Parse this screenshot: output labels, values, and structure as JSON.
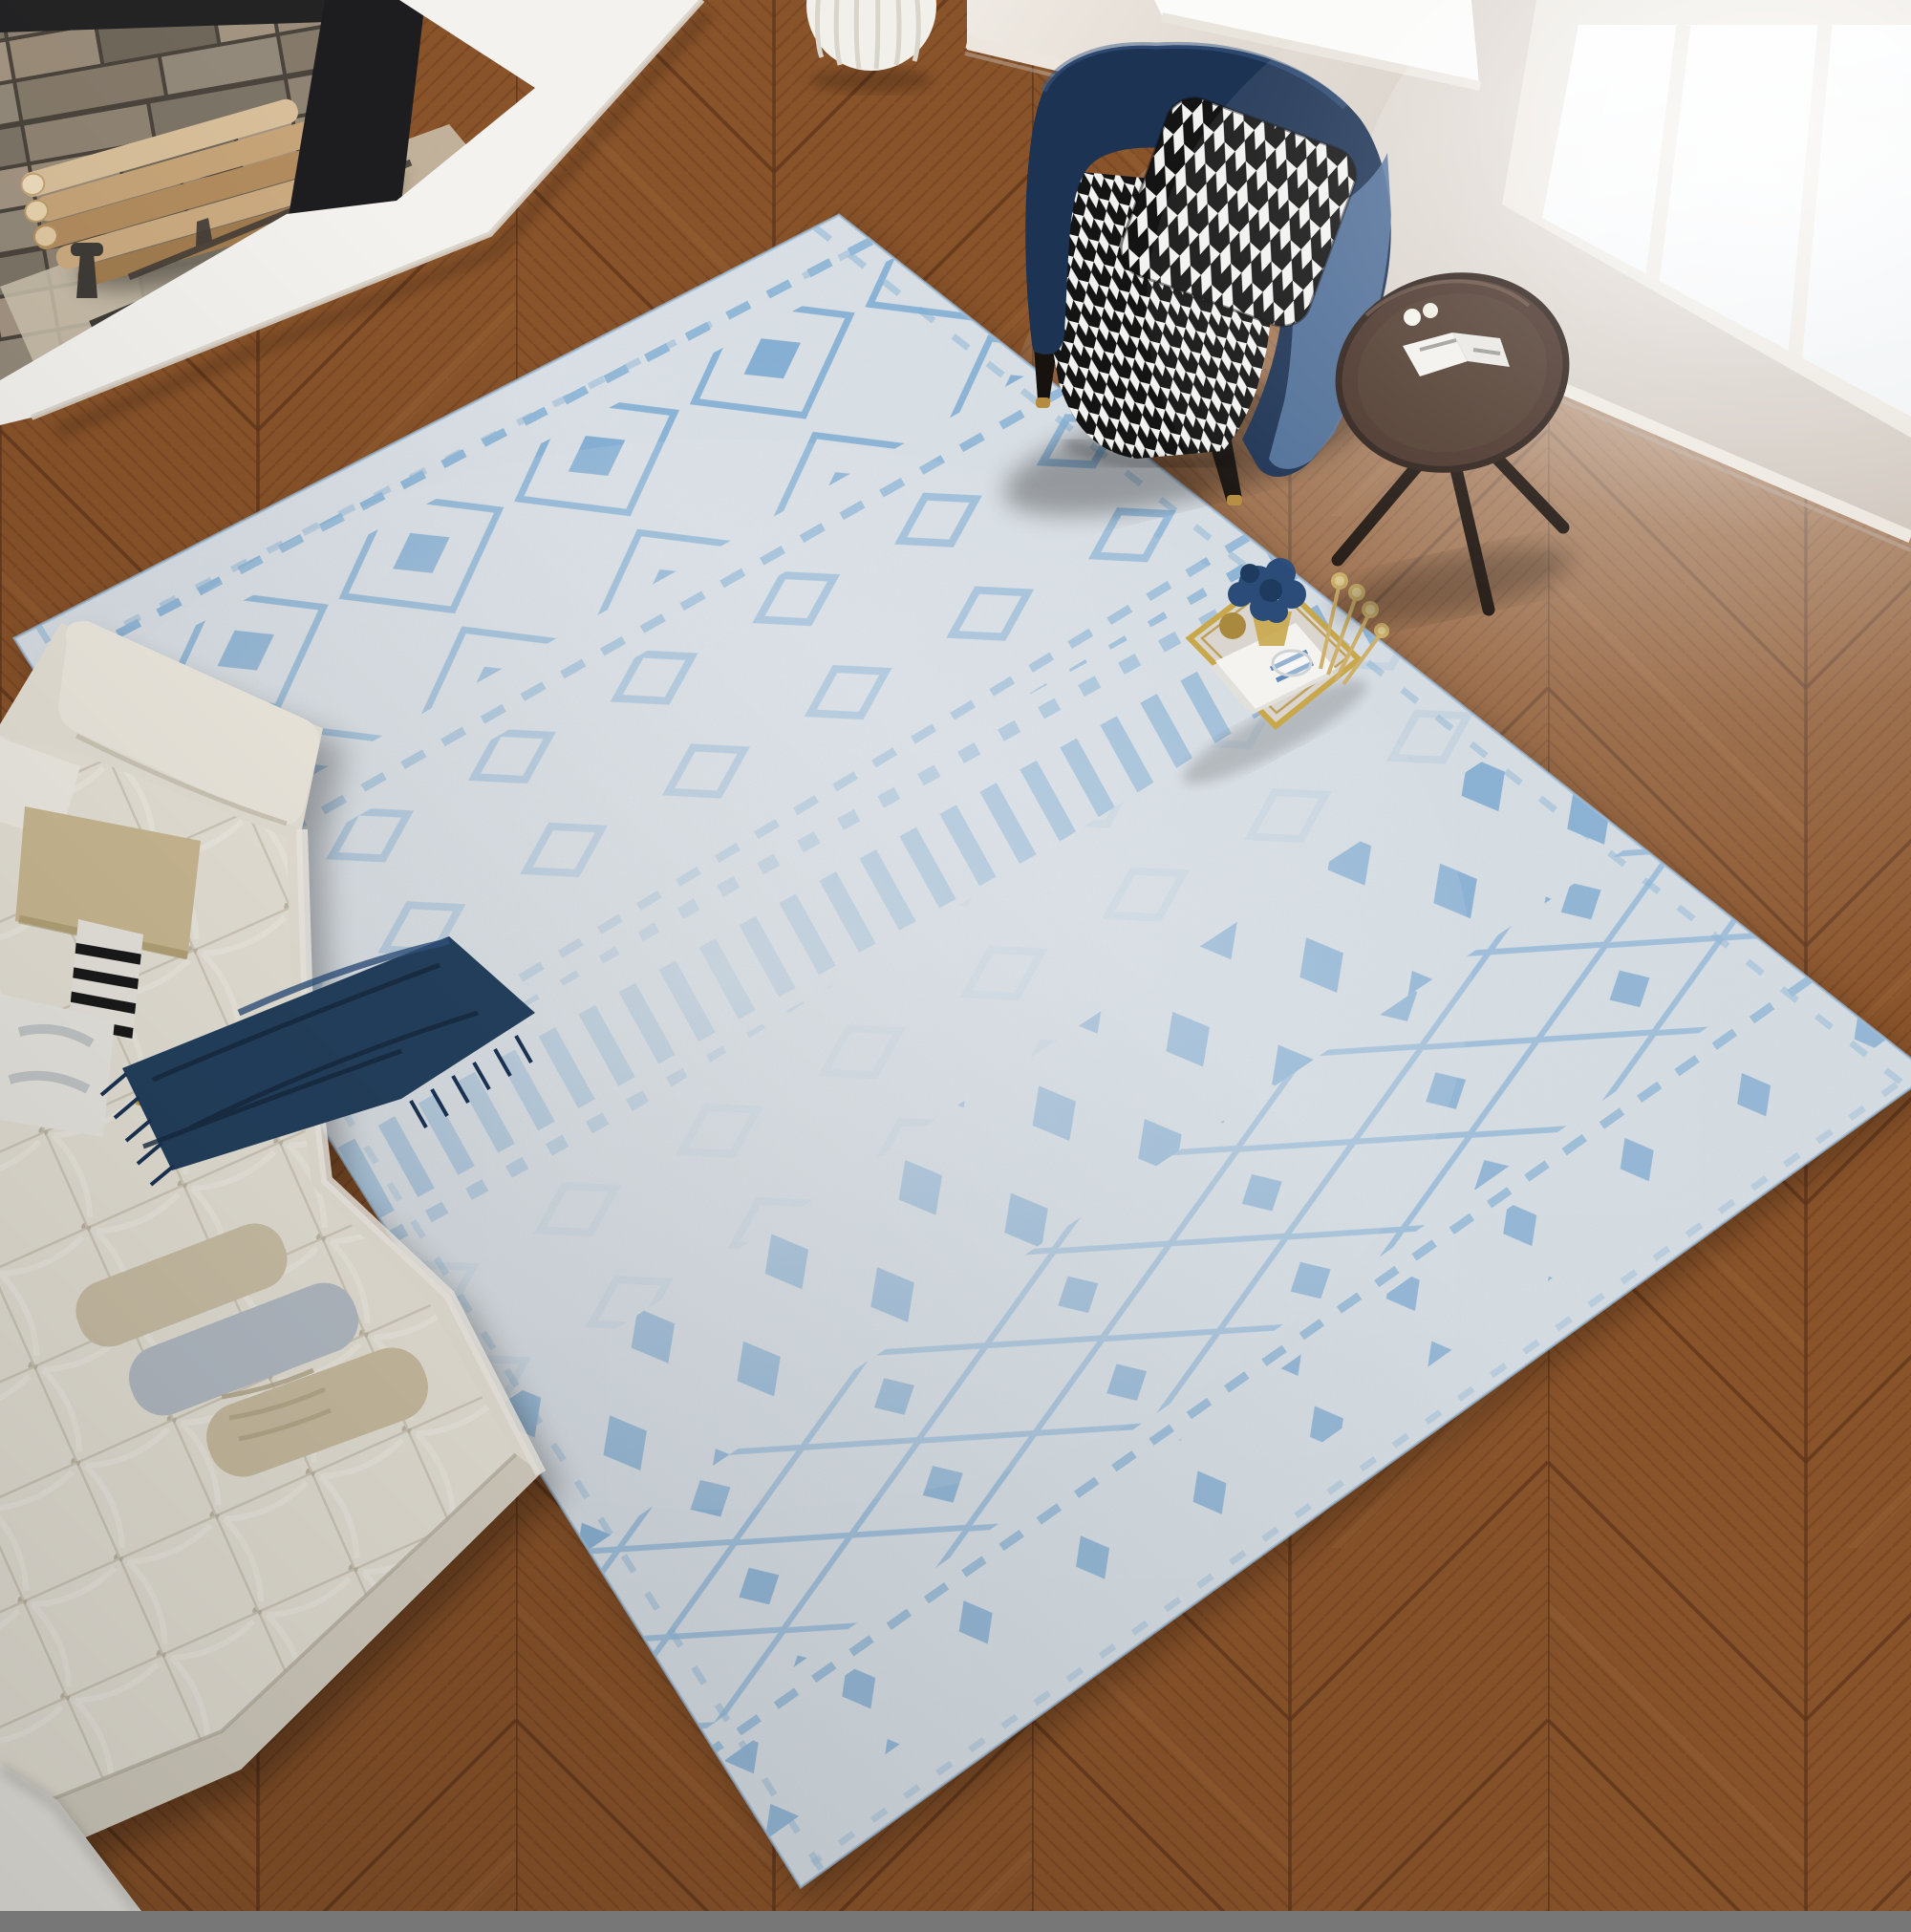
{
  "scene": {
    "title": "Top-down living room photo: light blue Moroccan diamond rug on chevron oak floor",
    "view": "overhead three-quarter product shot, daylight from right windows"
  },
  "objects": {
    "floor": "chevron oak parquet floor",
    "fireplace": "stone fireplace with firewood logs and iron andirons",
    "hearth": "white stone hearth slab",
    "basket": "white ribbed round planter",
    "wall": "greige wall with white baseboard",
    "window_left": "bright window above armchair",
    "window_right": "large bright window with mullions",
    "rug": "distressed light-blue Moroccan geometric area rug",
    "tray": "gold mirrored decor tray with navy hydrangeas, gold stems and books",
    "sofa": "cream tufted bench sofa with pillows",
    "throw": "navy fringed throw blanket",
    "armchair": "navy velvet armchair with houndstooth seat and pillow",
    "side_table": "dark wood tripod side table with open magazine",
    "ottoman": "white ottoman corner at bottom left"
  },
  "colors": {
    "floor_base": "#8a5329",
    "floor_grain": "#6b3a1c",
    "rug_base": "#dfe5ea",
    "rug_blue": "#6ea6d4",
    "rug_blue_deep": "#5f9bd0",
    "sofa_cream": "#e7e3d8",
    "throw_navy": "#24415f",
    "chair_navy": "#1d3354",
    "chair_side_blue": "#56759f",
    "houndstooth_black": "#141414",
    "houndstooth_white": "#f2f2f0",
    "hearth_white": "#f4f2ee",
    "wall_greige": "#d9d1c9",
    "trim_white": "#ece6de",
    "window_white": "#ffffff",
    "stone_gray": "#8d8171",
    "log_tan": "#c9a87e",
    "table_wood": "#4a342a",
    "brass_gold": "#b48c3f",
    "tray_gold": "#c9a84c"
  }
}
